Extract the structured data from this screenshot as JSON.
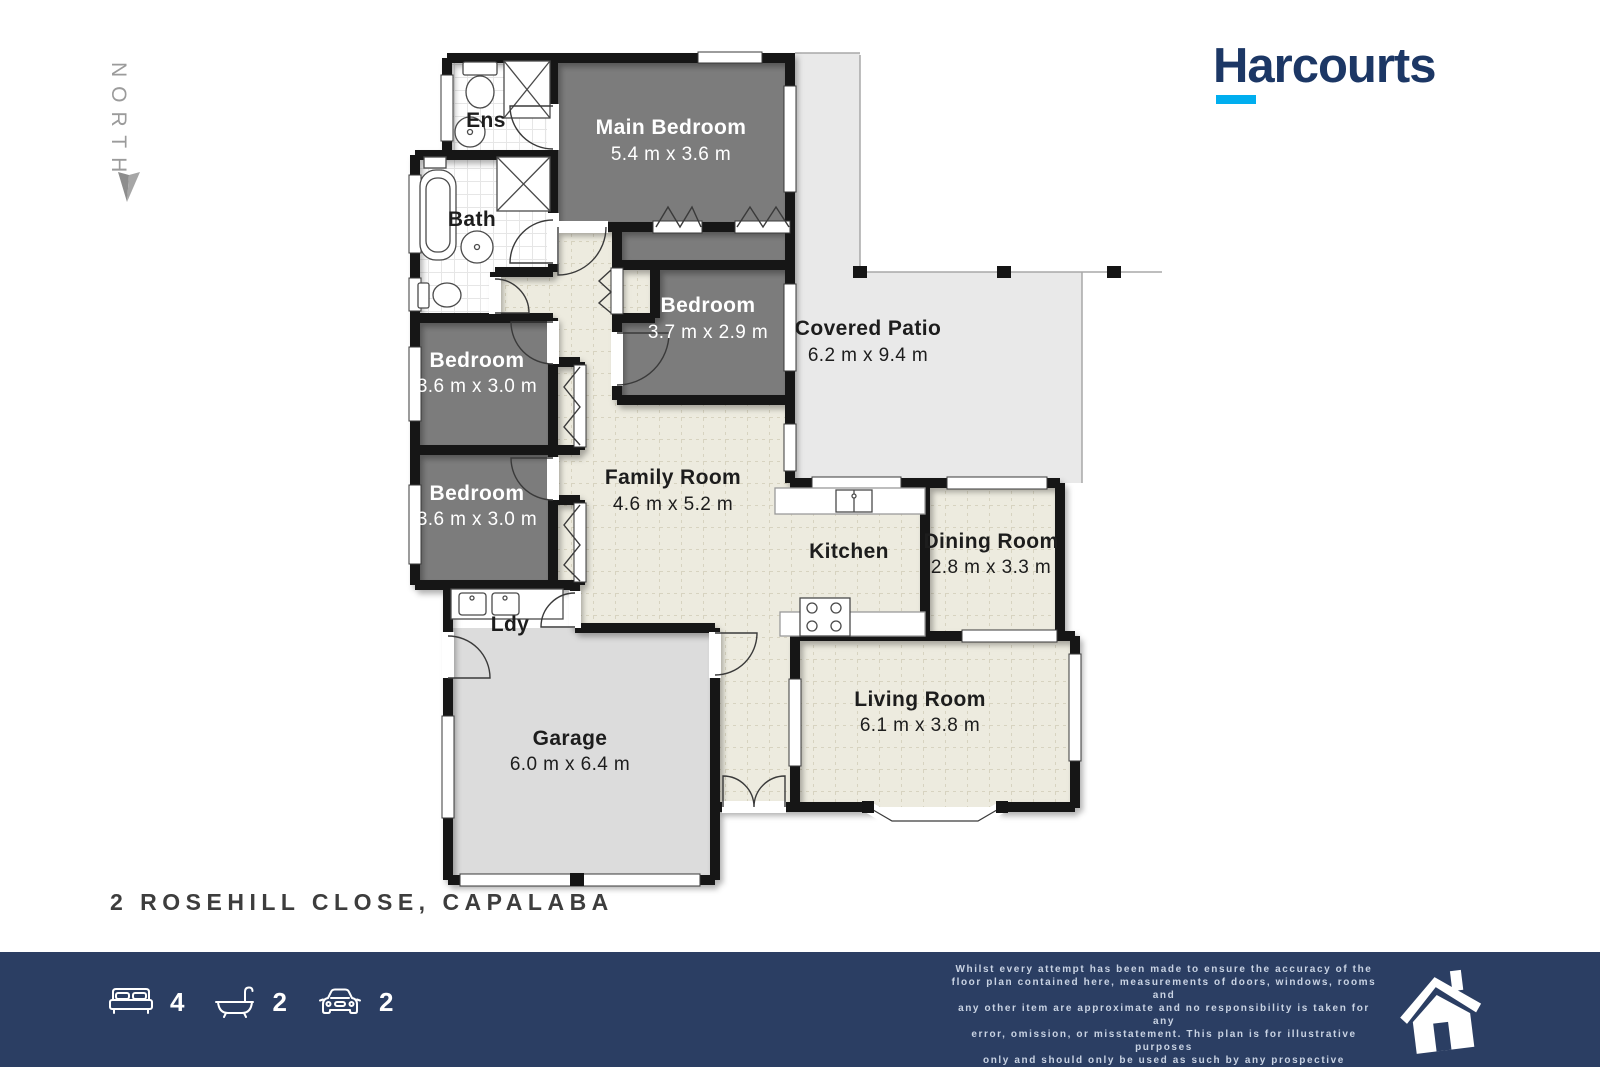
{
  "north": {
    "label": "NORTH"
  },
  "logo": {
    "text": "Harcourts",
    "brand_navy": "#1c3765",
    "brand_cyan": "#00aeef"
  },
  "address": "2 ROSEHILL CLOSE, CAPALABA",
  "rooms": {
    "ens": {
      "name": "Ens"
    },
    "main_bedroom": {
      "name": "Main Bedroom",
      "dims": "5.4 m x 3.6 m"
    },
    "bath": {
      "name": "Bath"
    },
    "bedroom2": {
      "name": "Bedroom",
      "dims": "3.7 m x 2.9 m"
    },
    "covered_patio": {
      "name": "Covered Patio",
      "dims": "6.2 m x 9.4 m"
    },
    "bedroom3": {
      "name": "Bedroom",
      "dims": "3.6 m x 3.0 m"
    },
    "bedroom4": {
      "name": "Bedroom",
      "dims": "3.6 m x 3.0 m"
    },
    "family_room": {
      "name": "Family Room",
      "dims": "4.6 m x 5.2 m"
    },
    "kitchen": {
      "name": "Kitchen"
    },
    "dining_room": {
      "name": "Dining Room",
      "dims": "2.8 m x 3.3 m"
    },
    "ldy": {
      "name": "Ldy"
    },
    "garage": {
      "name": "Garage",
      "dims": "6.0 m x 6.4 m"
    },
    "living_room": {
      "name": "Living Room",
      "dims": "6.1 m x 3.8 m"
    }
  },
  "footer": {
    "stats": [
      {
        "icon": "bed-icon",
        "value": "4"
      },
      {
        "icon": "bath-icon",
        "value": "2"
      },
      {
        "icon": "car-icon",
        "value": "2"
      }
    ],
    "disclaimer_lines": [
      "Whilst every attempt has been made to ensure the accuracy of the",
      "floor plan contained here, measurements of doors, windows, rooms and",
      "any other item are approximate and no responsibility is taken for any",
      "error, omission, or misstatement. This plan is for illustrative purposes",
      "only and should only be used as such by any prospective purchaser."
    ]
  }
}
